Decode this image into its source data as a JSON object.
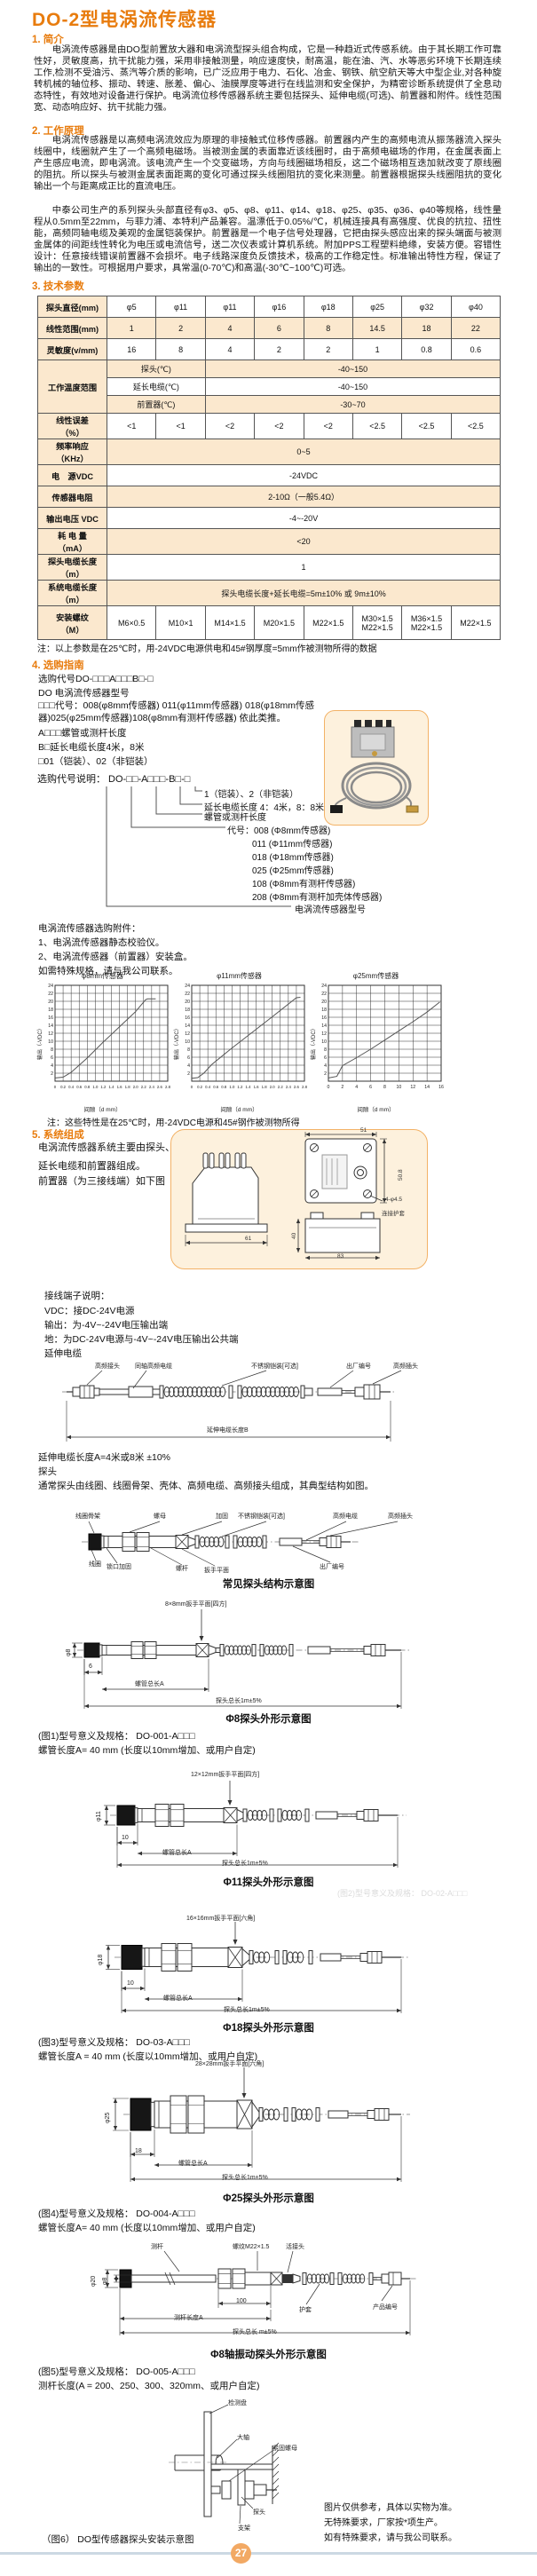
{
  "title": "DO-2型电涡流传感器",
  "s1": {
    "h": "1. 简介",
    "p": "电涡流传感器是由DO型前置放大器和电涡流型探头组合构成，它是一种趋近式传感系统。由于其长期工作可靠性好，灵敏度高，抗干扰能力强，采用非接触测量，响应速度快，耐高温，能在油、汽、水等恶劣环境下长期连续工作,检测不受油污、蒸汽等介质的影响，已广泛应用于电力、石化、冶金、钢铁、航空航天等大中型企业,对各种旋转机械的轴位移、振动、转速、胀差、偏心、油膜厚度等进行在线监测和安全保护，为精密诊断系统提供了全息动态特性，有效地对设备进行保护。电涡流位移传感器系统主要包括探头、延伸电缆(可选)、前置器和附件。线性范围宽、动态响应好、抗干扰能力强。"
  },
  "s2": {
    "h": "2. 工作原理",
    "p1": "电涡流传感器是以高频电涡流效应为原理的非接触式位移传感器。前置器内产生的高频电流从振荡器流入探头线圈中，线圈就产生了一个高频电磁场。当被测金属的表面靠近该线圈时，由于高频电磁场的作用，在金属表面上产生感应电流，即电涡流。该电流产生一个交变磁场，方向与线圈磁场相反，这二个磁场相互迭加就改变了原线圈的阻抗。所以探头与被测金属表面距离的变化可通过探头线圈阻抗的变化来测量。前置器根据探头线圈阻抗的变化输出一个与距离成正比的直流电压。",
    "p2": "中泰公司生产的系列探头头部直径有φ3、φ5、φ8、φ11、φ14、φ18、φ25、φ35、φ36、φ40等规格，线性量程从0.5mm至22mm，与菲力浦、本特利产品兼容。温漂低于0.05%/℃，机械连接具有高强度、优良的抗拉、扭性能，高频同轴电缆及美观的金属铠装保护。前置器是一个电子信号处理器，它把由探头感应出来的探头端面与被测金属体的间距线性转化为电压或电流信号，送二次仪表或计算机系统。附加PPS工程塑料绝缘，安装方便。容错性设计：任意接线错误前置器不会损坏。电子线路深度负反馈技术，极高的工作稳定性。标准输出特性方程，保证了输出的一致性。可根据用户要求，具常温(0-70℃)和高温(-30℃~100℃)可选。"
  },
  "s3": {
    "h": "3. 技术参数",
    "table": {
      "diameter": {
        "label": "探头直径(mm)",
        "cells": [
          "φ5",
          "φ11",
          "φ11",
          "φ16",
          "φ18",
          "φ25",
          "φ32",
          "φ40"
        ]
      },
      "range": {
        "label": "线性范围(mm)",
        "cells": [
          "1",
          "2",
          "4",
          "6",
          "8",
          "14.5",
          "18",
          "22"
        ]
      },
      "sensitivity": {
        "label": "灵敏度(v/mm)",
        "cells": [
          "16",
          "8",
          "4",
          "2",
          "2",
          "1",
          "0.8",
          "0.6"
        ]
      },
      "temp": {
        "label": "工作温度范围",
        "rows": [
          [
            "探头(℃)",
            "-40~150"
          ],
          [
            "延长电缆(℃)",
            "-40~150"
          ],
          [
            "前置器(℃)",
            "-30~70"
          ]
        ]
      },
      "error": {
        "label": "线性误差\n（%）",
        "cells": [
          "<1",
          "<1",
          "<2",
          "<2",
          "<2",
          "<2.5",
          "<2.5",
          "<2.5"
        ]
      },
      "freq": {
        "label": "频率响应\n（KHz）",
        "value": "0~5"
      },
      "power": {
        "label": "电　源VDC",
        "value": "-24VDC"
      },
      "resistance": {
        "label": "传感器电阻",
        "value": "2-10Ω（一般5.4Ω）"
      },
      "outv": {
        "label": "输出电压 VDC",
        "value": "-4~-20V"
      },
      "consumption": {
        "label": "耗 电 量\n（mA）",
        "value": "<20"
      },
      "cablelen": {
        "label": "探头电缆长度\n（m）",
        "value": "1"
      },
      "syslen": {
        "label": "系统电缆长度\n（m）",
        "value": "探头电缆长度+延长电缆=5m±10% 或 9m±10%"
      },
      "thread": {
        "label": "安装螺纹\n（M）",
        "cells": [
          "M6×0.5",
          "M10×1",
          "M14×1.5",
          "M20×1.5",
          "M22×1.5",
          "M30×1.5|M22×1.5",
          "M36×1.5|M22×1.5",
          "M22×1.5"
        ]
      }
    },
    "note": "注：以上参数是在25℃时，用-24VDC电源供电和45#钢厚度=5mm作被测物所得的数据"
  },
  "s4": {
    "h": "4. 选购指南",
    "lines": [
      "选购代号DO-□□□A□□□B□-□",
      "DO 电涡流传感器型号",
      "□□□代号：008(φ8mm传感器) 011(φ11mm传感器) 018(φ18mm传感器)025(φ25mm传感器)108(φ8mm有测杆传感器) 依此类推。",
      "A□□□螺管或测杆长度",
      "B□延长电缆长度4米，8米",
      "□01（铠装）、02（非铠装）"
    ],
    "code_line": "选购代号说明： DO-□□-A□□□-B□-□",
    "tree": [
      "1（铠装）、2（非铠装）",
      "延长电缆长度 4：4米，8：8米",
      "螺管或测杆长度",
      "代号：008 (Φ8mm传感器)",
      "011 (Φ11mm传感器)",
      "018 (Φ18mm传感器)",
      "025 (Φ25mm传感器)",
      "108 (Φ8mm有测杆传感器)",
      "208 (Φ8mm有测杆加壳体传感器)",
      "电涡流传感器型号"
    ],
    "accessories": [
      "电涡流传感器选购附件：",
      "1、电涡流传感器静态校验仪。",
      "2、电涡流传感器（前置器）安装盒。",
      "如需特殊规格，请与我公司联系。"
    ]
  },
  "chart_note": "注：这些特性是在25℃时，用-24VDC电源和45#钢作被测物所得",
  "chart_data": [
    {
      "type": "line",
      "title": "φ8mm传感器",
      "xlabel": "间隙（d mm）",
      "ylabel": "输出（-VDC）",
      "xlim": [
        0,
        2.8
      ],
      "xtick_step": 0.2,
      "ylim": [
        0,
        24
      ],
      "ytick_step": 2,
      "grid": true,
      "points": [
        [
          0,
          0.8
        ],
        [
          0.2,
          1.0
        ],
        [
          0.4,
          2.2
        ],
        [
          0.8,
          5.8
        ],
        [
          1.2,
          9.8
        ],
        [
          1.6,
          13.6
        ],
        [
          2.0,
          17.4
        ],
        [
          2.25,
          20.4
        ],
        [
          2.3,
          20.6
        ],
        [
          2.5,
          20.6
        ]
      ]
    },
    {
      "type": "line",
      "title": "φ11mm传感器",
      "xlabel": "间隙（d mm）",
      "ylabel": "输出（-VDC）",
      "xlim": [
        0,
        2.8
      ],
      "xtick_step": 0.2,
      "ylim": [
        0,
        24
      ],
      "ytick_step": 2,
      "grid": true,
      "points": [
        [
          0,
          0.7
        ],
        [
          0.15,
          0.9
        ],
        [
          0.3,
          2.0
        ],
        [
          0.5,
          4.2
        ],
        [
          1.0,
          8.3
        ],
        [
          1.5,
          12.2
        ],
        [
          2.0,
          16.1
        ],
        [
          2.6,
          20.9
        ],
        [
          2.7,
          21.0
        ]
      ]
    },
    {
      "type": "line",
      "title": "φ25mm传感器",
      "xlabel": "间隙（d mm）",
      "ylabel": "输出（-VDC）",
      "xlim": [
        0,
        16
      ],
      "xtick_step": 2,
      "ylim": [
        0,
        24
      ],
      "ytick_step": 2,
      "grid": true,
      "points": [
        [
          0,
          0.8
        ],
        [
          1.2,
          1.2
        ],
        [
          2,
          3.9
        ],
        [
          4,
          5.9
        ],
        [
          6,
          8.0
        ],
        [
          8,
          10.3
        ],
        [
          10,
          12.6
        ],
        [
          12,
          14.9
        ],
        [
          14,
          17.3
        ],
        [
          15.8,
          19.8
        ]
      ]
    }
  ],
  "s5": {
    "h": "5. 系统组成",
    "lines": [
      "电涡流传感器系统主要由探头、",
      "延长电缆和前置器组成。",
      "前置器（为三接线端）如下图"
    ],
    "preamp_dims": {
      "w61": "61",
      "w51": "51",
      "h508": "50.8",
      "holes": "4-φ4.5",
      "sheath": "连接护套",
      "h40": "40",
      "w83": "83"
    }
  },
  "terminals": {
    "head": "接线端子说明：",
    "lines": [
      "VDC：接DC-24V电源",
      "输出：为-4V~-24V电压输出端",
      "地：为DC-24V电源与-4V~-24V电压输出公共端"
    ],
    "ext_head": "延伸电缆"
  },
  "ext_fig": {
    "labels": [
      "高频接头",
      "同轴高频电缆",
      "不锈钢铠装[可选]",
      "出厂编号",
      "高频插头"
    ],
    "dim_b": "延伸电缆长度B",
    "len_note": "延伸电缆长度A=4米或8米 ±10%",
    "probe_head": "探头",
    "probe_desc": "通常探头由线圈、线圈骨架、壳体、高频电缆、高频接头组成，其典型结构如图。"
  },
  "probe_fig": {
    "top_labels": [
      "线圈骨架",
      "螺母",
      "加固",
      "不锈钢铠装[可选]",
      "高频电缆",
      "高频插头"
    ],
    "bottom_labels": [
      "线圈",
      "锁口加固",
      "螺杆",
      "扳手平面",
      "出厂编号"
    ],
    "caption": "常见探头结构示意图"
  },
  "fig8": {
    "wrench": "8×8mm扳手平面[四方]",
    "dia": "φ8",
    "tip": "6",
    "dimA": "螺管总长A",
    "total": "探头总长1m±5%",
    "caption": "Φ8探头外形示意图",
    "model": "(图1)型号意义及规格： DO-001-A□□□",
    "len": "螺管长度A= 40 mm (长度以10mm增加、或用户自定)"
  },
  "fig11": {
    "wrench": "12×12mm扳手平面[四方]",
    "dia": "φ11",
    "tip": "10",
    "dimA": "螺管总长A",
    "total": "探头总长1m±5%",
    "caption": "Φ11探头外形示意图",
    "faint": "(图2)型号意义及规格： DO-02-A□□□"
  },
  "fig18": {
    "wrench": "16×16mm扳手平面[六角]",
    "dia": "φ18",
    "tip": "10",
    "dimA": "螺管总长A",
    "total": "探头总长1m±5%",
    "caption": "Φ18探头外形示意图",
    "model": "(图3)型号意义及规格： DO-03-A□□□",
    "len": "螺管长度A = 40 mm (长度以10mm增加、或用户自定)"
  },
  "fig25": {
    "wrench": "28×28mm扳手平面[六角]",
    "dia": "φ25",
    "tip": "18",
    "dimA": "螺管总长A",
    "total": "探头总长1m±5%",
    "caption": "Φ25探头外形示意图",
    "model": "(图4)型号意义及规格： DO-004-A□□□",
    "len": "螺管长度A= 40 mm (长度以10mm增加、或用户自定)"
  },
  "figvib": {
    "rod": "测杆",
    "thread": "螺纹M22×1.5",
    "union": "活接头",
    "dia20": "φ20",
    "dia8": "φ8",
    "d100": "100",
    "dimA": "测杆长度A",
    "sheath": "护套",
    "serial": "产品编号",
    "total": "探头总长 m±5%",
    "caption": "Φ8轴振动探头外形示意图",
    "model": "(图5)型号意义及规格： DO-005-A□□□",
    "len": "测杆长度(A = 200、250、300、320mm、或用户自定)"
  },
  "fig6": {
    "labels": [
      "检测盘",
      "大轴",
      "紧固螺母",
      "探头",
      "支架"
    ],
    "caption": "（图6） DO型传感器探头安装示意图"
  },
  "footer": {
    "notes": [
      "图片仅供参考，具体以实物为准。",
      "无特殊要求，厂家按*项生产。",
      "如有特殊要求，请与我公司联系。"
    ],
    "page": "27"
  },
  "colors": {
    "accent": "#e87c0e",
    "table_shade": "#fbe8ce",
    "panel": "#fdf1dd",
    "panel_border": "#f3b266"
  }
}
